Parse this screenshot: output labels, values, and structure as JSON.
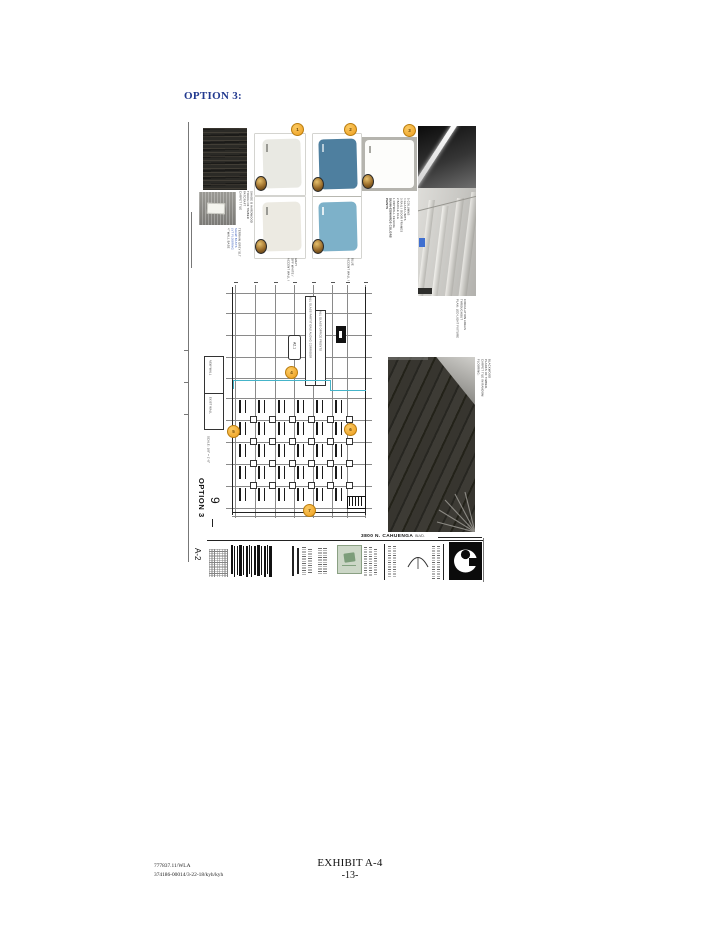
{
  "page": {
    "header": "OPTION 3:",
    "footer": {
      "ref_line1": "777837.11/WLA",
      "ref_line2": "374186-00014/3-22-18/kyh/kyh",
      "exhibit_label": "EXHIBIT A-4",
      "page_number": "-13-"
    }
  },
  "colors": {
    "header_blue": "#21398f",
    "swatch_off_white": "#e9e9e3",
    "swatch_blue_dark": "#4e7f9f",
    "swatch_blue_light": "#7db1c9",
    "callout_orange": "#f1a42c",
    "highlight_teal": "#45b4c9",
    "stamp_green": "#ccd7c7"
  },
  "samples": {
    "carpet_note": "CARPET TILE\nPATCRAFT\nTOUCH OF TIMBER\nSHADE B HARDWOOD",
    "base_note_1": "4\" WALL BASE",
    "base_note_2": "LVT FLOORING\nSHAW BASYS",
    "base_note_3": "TERRAIN GREY 517",
    "accent_caption_1": "ACCENT WALL /\nOFF WHITE /\nGRAY",
    "accent_caption_2": "ACCENT WALL /\nBLUE",
    "paint_legend": "PAINTS\nDUNN-EDWARDS COLORS",
    "paint_items": "1 DRYWALL CEILING\n2 BAFFLE CLG\n3 RAIL / DOOR FRAMES\n4 GLASS UNITS\n5 COLUMNS",
    "lighting_caption": "PLAN: LED LIGHT FIXTURE\nTHROUGHOUT\nCIRCULATION AREAS",
    "flooring_caption": "FLOORING:\nCARPET TILE IN RANDOM\nPLANKS OF TIMBER,\nBLACKWOOD"
  },
  "plan": {
    "note_box_1": "ALL GLASS PARTITIONS ALONG CORRIDOR",
    "note_box_2": "ALL GLASS OFFICE FRONTS",
    "detail_tag": "A2.1",
    "legend_row_1": "NEW WALL",
    "legend_row_2": "EXIST WALL",
    "scale_note": "SCALE: 1/8\" = 1'-0\"",
    "option_label": "OPTION 3",
    "big_figure": "9"
  },
  "titleblock": {
    "sheet_number": "A-2",
    "project_address": "3800 N. CAHUENGA",
    "project_address_tail": "BLVD."
  },
  "callouts": [
    "1",
    "2",
    "3",
    "4",
    "5",
    "6",
    "7"
  ]
}
